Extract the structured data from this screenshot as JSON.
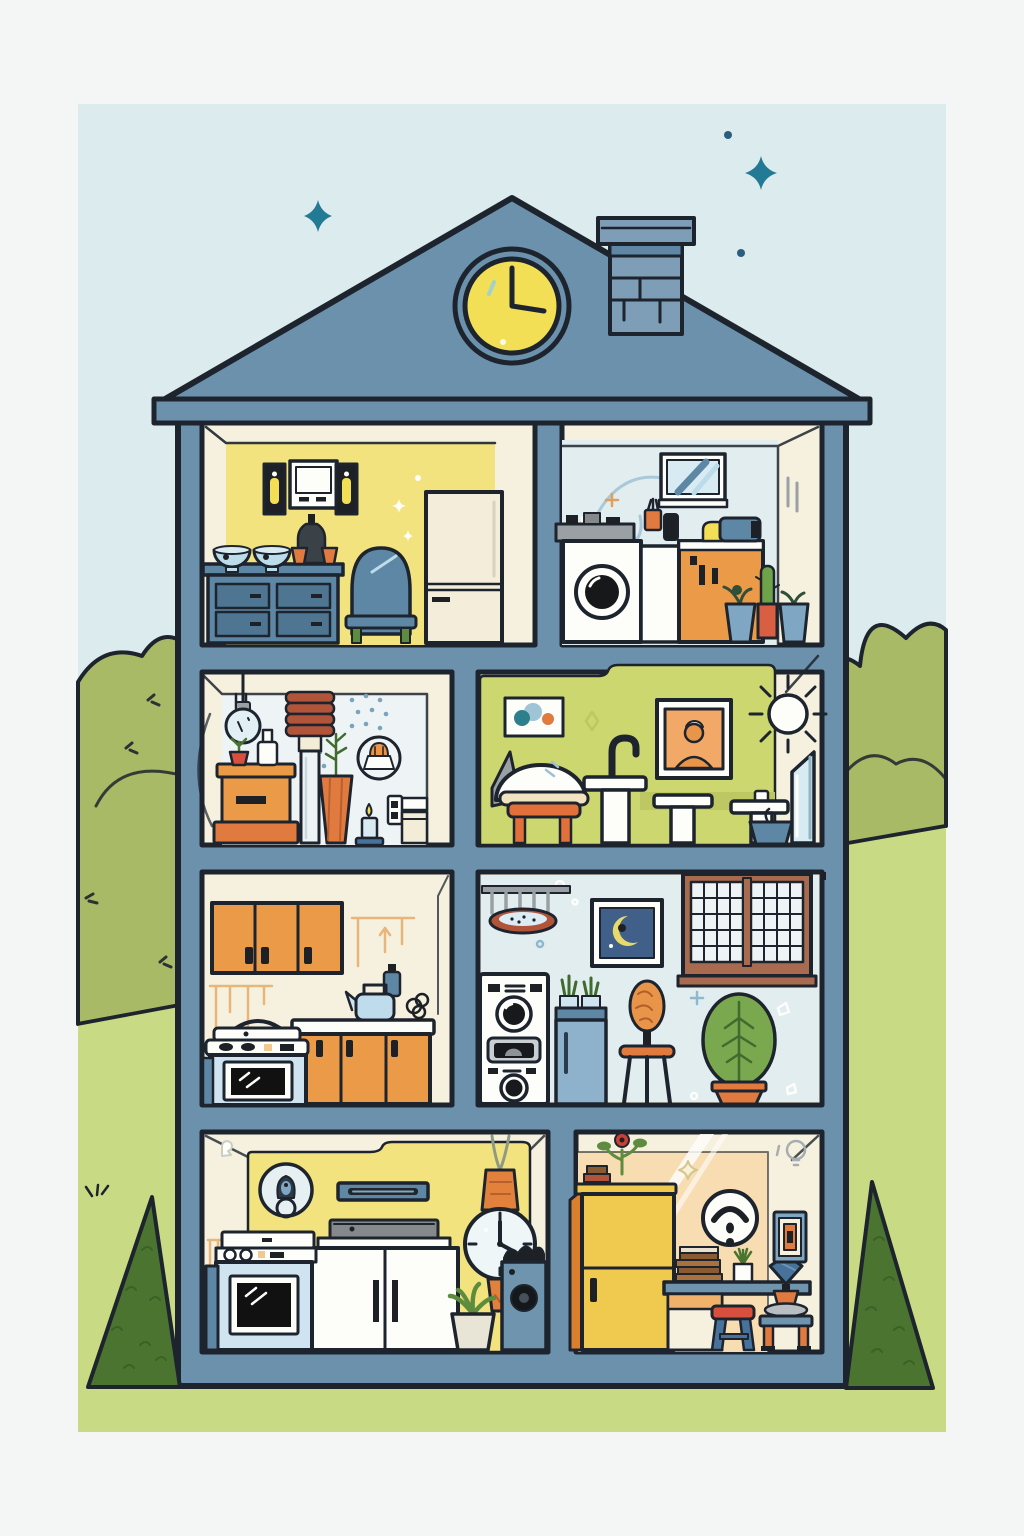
{
  "scene": {
    "title": "house-cross-section-illustration",
    "clock_time": "3:00",
    "sky_marks": [
      "four-point-star-left",
      "four-point-star-right",
      "dot",
      "dot"
    ],
    "landscape": [
      "left-bush",
      "right-bush",
      "left-hill",
      "right-hill",
      "left-pine-tree",
      "right-pine-tree"
    ],
    "house_parts": [
      "roof",
      "roof-clock",
      "chimney",
      "outer-walls",
      "floor-slabs",
      "base"
    ],
    "rooms": [
      {
        "id": "attic-dining-room",
        "floor": 1,
        "side": "left",
        "wall_color_key": "yellow_wall",
        "items": [
          "candle-sconce",
          "medicine-cabinet",
          "candle-sconce",
          "bowl",
          "bowl",
          "dark-bottle-with-cups",
          "blue-dresser",
          "blue-chair",
          "refrigerator",
          "wall-sparkles"
        ]
      },
      {
        "id": "attic-laundry-room",
        "floor": 1,
        "side": "right",
        "wall_color_key": "blue_wall",
        "items": [
          "striped-mirror",
          "utility-shelf",
          "washing-machine",
          "side-cabinet",
          "cup-with-utensils",
          "black-jar",
          "orange-cabinet",
          "sewing-machine",
          "potted-plant",
          "cactus-pot",
          "potted-plant",
          "wall-squiggles"
        ]
      },
      {
        "id": "utility-room",
        "floor": 2,
        "side": "left",
        "wall_color_key": "pale_wall",
        "items": [
          "pendant-bulb",
          "coil-column",
          "storage-chest",
          "chest-plant",
          "white-bottle",
          "carrot-planter",
          "candle",
          "lamp-roundel",
          "paper-holder",
          "wall-dots"
        ]
      },
      {
        "id": "bathroom",
        "floor": 2,
        "side": "right",
        "wall_color_key": "green_wall",
        "items": [
          "dot-artwork",
          "salon-dryer-chair",
          "hooked-faucet-sink",
          "pedestal-sink",
          "pedestal-sink",
          "portrait-frame",
          "sun-burst",
          "planter-bowl",
          "leaning-mirror"
        ]
      },
      {
        "id": "kitchen",
        "floor": 3,
        "side": "left",
        "wall_color_key": "cream",
        "items": [
          "upper-cabinets",
          "hanging-decor-lines",
          "counter-cabinets",
          "kettle",
          "blue-bottle",
          "wire-plant",
          "stove-oven"
        ]
      },
      {
        "id": "family-laundry-room",
        "floor": 3,
        "side": "right",
        "wall_color_key": "blue_wall",
        "items": [
          "hanging-pot-rack",
          "moon-artwork",
          "grid-window",
          "stacked-washer-dryer",
          "mini-fridge",
          "succulent-tray",
          "wig-stand-stool",
          "potted-tree",
          "wall-sparkles"
        ]
      },
      {
        "id": "media-room",
        "floor": 4,
        "side": "left",
        "wall_color_key": "yellow_wall",
        "items": [
          "doorbell-roundel",
          "wall-console-shelf",
          "soundbar",
          "media-cabinet",
          "stove-oven",
          "wall-watch",
          "potted-plant",
          "speaker",
          "wall-fringe"
        ]
      },
      {
        "id": "home-office",
        "floor": 4,
        "side": "right",
        "wall_color_key": "peach_wall",
        "items": [
          "yellow-wardrobe",
          "wardrobe-books-bowls-plant",
          "smiley-roundel",
          "light-streaks",
          "desk",
          "book-stack",
          "desk-plant",
          "drawer-unit",
          "red-stool",
          "vase-side-table",
          "wall-frame",
          "bulb-doodle",
          "sparkle"
        ]
      }
    ]
  },
  "palette": {
    "page_bg": "#f4f6f6",
    "sky": "#dcebee",
    "hill": "#c8da83",
    "bush": "#a9ba66",
    "tree": "#4a7430",
    "tree_texture": "#3a5f26",
    "outline": "#1d242e",
    "house_blue": "#6b91ad",
    "house_blue_light": "#7e9db6",
    "steel": "#5d87a5",
    "steel_dark": "#4e7693",
    "cream": "#f6f1df",
    "cream_panel": "#f3ecd7",
    "yellow_wall": "#f3e37e",
    "blue_wall": "#e2edf0",
    "pale_wall": "#eef4f5",
    "green_wall": "#cdd76f",
    "green_wall_dark": "#bdc862",
    "peach_wall": "#f8dcb2",
    "white": "#fdfdfa",
    "clock_yellow": "#f2df55",
    "orange": "#eb9a47",
    "orange_dark": "#d97f2e",
    "pot_orange": "#e07a3f",
    "skin_orange": "#e8954a",
    "red_brown": "#b2543a",
    "red": "#d94f3d",
    "appliance_blue": "#cfe4f0",
    "bowl_blue": "#bcdcea",
    "glass_blue": "#d8ebf3",
    "gray": "#9aa0a3",
    "slab_gray": "#85898c",
    "dark": "#1d2125",
    "leaf_green": "#5d8c3f",
    "tree_leaf": "#7aa84e",
    "leaf_dark": "#3f6b2f",
    "teal_star": "#237a94",
    "wardrobe_yellow": "#f0c94f",
    "window_brown": "#a86b4f",
    "navy_art": "#40608a",
    "decor_orange": "#e8b57a",
    "squiggle_blue": "#a9c9d8",
    "fridge_blue": "#8fb2cc"
  }
}
